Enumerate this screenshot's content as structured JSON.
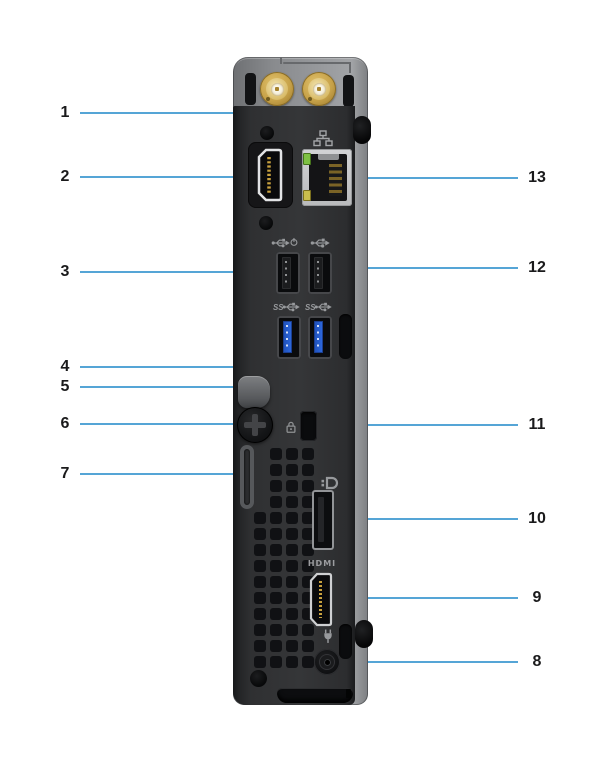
{
  "figure": {
    "type": "hardware-rear-view-callout-diagram",
    "background_color": "#ffffff",
    "callout_line_color": "#55a5d6",
    "callout_number_color": "#1a1a1b",
    "left_callouts": [
      "1",
      "2",
      "3",
      "4",
      "5",
      "6",
      "7"
    ],
    "right_callouts": [
      "13",
      "12",
      "11",
      "10",
      "9",
      "8"
    ],
    "device_text": {
      "hdmi_logo": "HDMI",
      "usb3_left_label": "SS",
      "usb3_right_label": "SS"
    },
    "icons": {
      "antennas": "sma-antenna-connector",
      "usb2_left": "usb-smartpower-icon",
      "usb2_right": "usb-icon",
      "usb3_left": "superspeed-usb-icon",
      "usb3_right": "superspeed-usb-icon",
      "ethernet": "network-icon",
      "displayport": "displayport-icon",
      "power": "power-plug-icon",
      "kensington": "security-lock-icon"
    }
  }
}
